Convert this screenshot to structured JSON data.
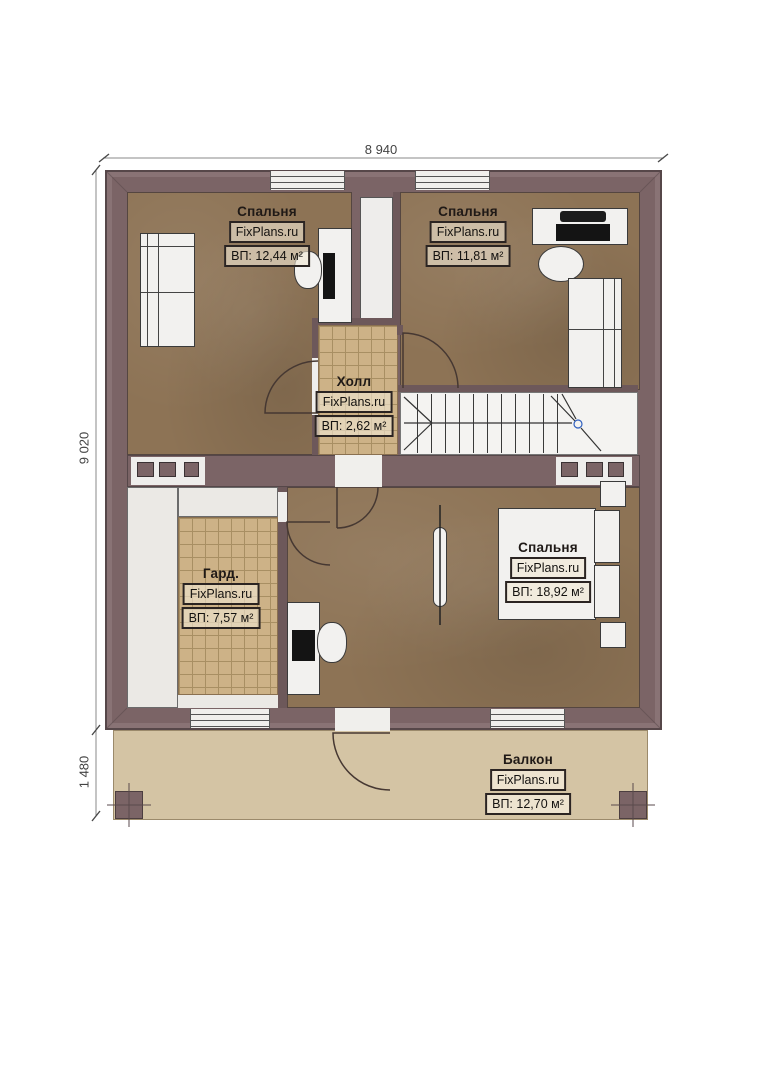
{
  "title": "Floor plan — second storey",
  "watermark": "FixPlans.ru",
  "dimensions": {
    "width_top": "8 940",
    "height_left": "9 020",
    "balcony_depth": "1 480"
  },
  "rooms": {
    "bedroom_tl": {
      "name": "Спальня",
      "brand": "FixPlans.ru",
      "area": "ВП: 12,44 м²"
    },
    "bedroom_tr": {
      "name": "Спальня",
      "brand": "FixPlans.ru",
      "area": "ВП: 11,81 м²"
    },
    "hall": {
      "name": "Холл",
      "brand": "FixPlans.ru",
      "area": "ВП: 2,62 м²"
    },
    "wardrobe": {
      "name": "Гард.",
      "brand": "FixPlans.ru",
      "area": "ВП: 7,57 м²"
    },
    "bedroom_br": {
      "name": "Спальня",
      "brand": "FixPlans.ru",
      "area": "ВП: 18,92 м²"
    },
    "balcony": {
      "name": "Балкон",
      "brand": "FixPlans.ru",
      "area": "ВП: 12,70 м²"
    }
  },
  "colors": {
    "wall": "#7b6466",
    "wood_floor": "#8d7355",
    "tile_floor": "#cdb287",
    "balcony_floor": "#d4c4a4",
    "stair_marker_blue": "#2f5fbf"
  }
}
